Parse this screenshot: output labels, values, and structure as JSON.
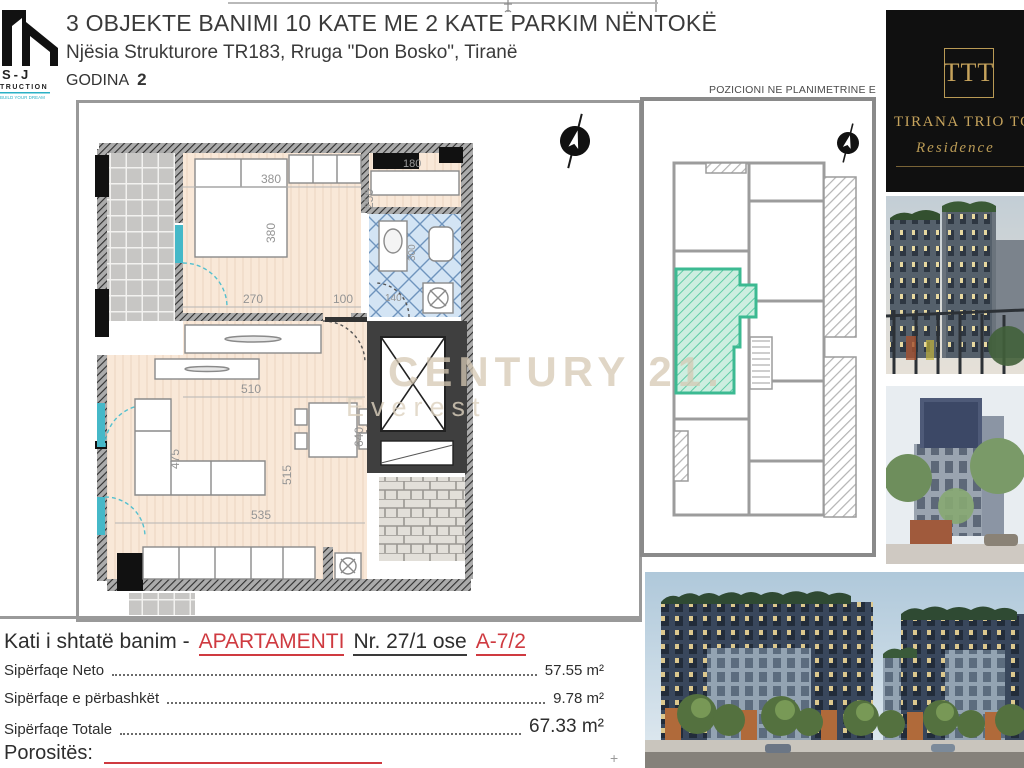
{
  "header": {
    "title": "3 OBJEKTE BANIMI 10 KATE ME 2 KATE PARKIM NËNTOKË",
    "subtitle": "Njësia Strukturore TR183, Rruga \"Don Bosko\", Tiranë",
    "godina_label": "GODINA",
    "godina_value": "2",
    "logo": {
      "brand": "S-J",
      "brand_sub": "TRUCTION",
      "tagline": "BUILD YOUR DREAM"
    }
  },
  "plan": {
    "dims": {
      "bed_w": "380",
      "bed_h": "380",
      "d270": "270",
      "d100": "100",
      "d250": "250",
      "d180": "180",
      "d300": "300",
      "d140": "140",
      "d510": "510",
      "d475": "475",
      "d515": "515",
      "d535": "535",
      "d640": "640"
    },
    "watermark_line1": "CENTURY 21.",
    "watermark_line2": "Everest"
  },
  "key_plan": {
    "title": "POZICIONI NE PLANIMETRINE E PERGJITHSHME"
  },
  "brand": {
    "monogram": "TTT",
    "name": "TIRANA TRIO TOWERS",
    "subname": "Residence"
  },
  "details": {
    "floor_prefix": "Kati i shtatë banim -",
    "apartment_label": "APARTAMENTI",
    "number_text": "Nr. 27/1 ose",
    "unit_code": "A-7/2",
    "rows": [
      {
        "label": "Sipërfaqe Neto",
        "value": "57.55 m²"
      },
      {
        "label": "Sipërfaqe e përbashkët",
        "value": "9.78 m²"
      },
      {
        "label": "Sipërfaqe Totale",
        "value": "67.33 m²"
      }
    ],
    "client_label": "Porositës:"
  },
  "colors": {
    "accent_red": "#cf3a40",
    "highlight_teal": "#3fbf97",
    "gold": "#c6a35c",
    "watermark": "#d6c9b4",
    "wall_gray": "#3c3c3c",
    "floor_peach": "#f9e8d8",
    "bath_blue": "#d3e4f4"
  }
}
